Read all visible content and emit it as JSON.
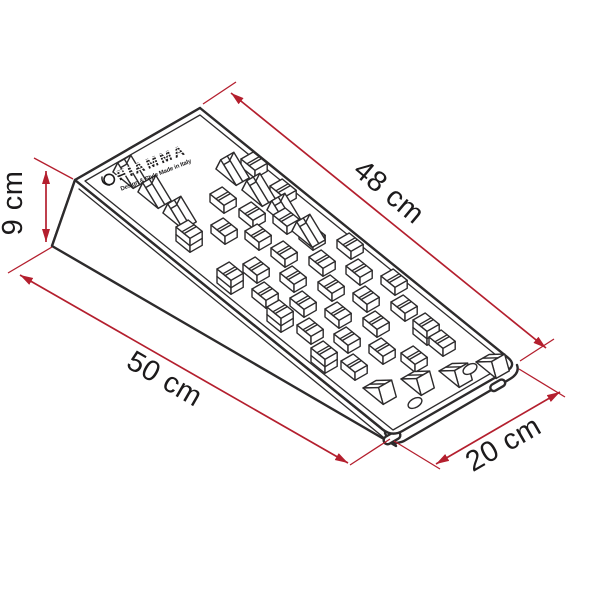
{
  "diagram": {
    "logo": {
      "brand": "FIAMMA",
      "tagline": "Design & Style Made in Italy"
    },
    "dimensions": {
      "top_edge": "48 cm",
      "height": "9 cm",
      "base": "50 cm",
      "width": "20 cm"
    },
    "colors": {
      "dimension_lines": "#b41f2e",
      "drawing_lines": "#2d2b2c",
      "label_text": "#1c1a1b",
      "background": "#ffffff"
    }
  }
}
